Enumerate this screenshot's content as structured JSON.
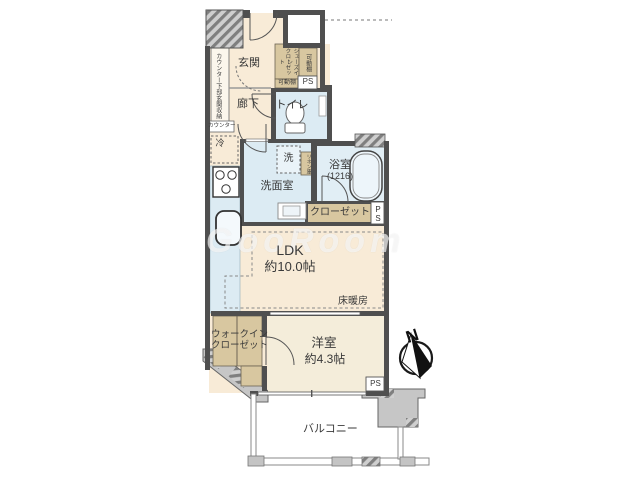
{
  "t": {
    "entrance": "玄関",
    "hallway": "廊下",
    "toilet": "トイレ",
    "washroom": "洗面室",
    "bath": "浴室",
    "bath_size": "(1216)",
    "closet": "クローゼット",
    "ldk": "LDK",
    "ldk_size": "約10.0帖",
    "floor_heating": "床暖房",
    "western": "洋室",
    "western_size": "約4.3帖",
    "balcony": "バルコニー",
    "wic1": "ウォークイン",
    "wic2": "クローゼット",
    "sic1": "シューズイン",
    "sic2": "クローゼット",
    "shelf_v": "可動棚",
    "shelf_h": "可動棚",
    "counter_storage": "カウンター下部玄関収納",
    "counter": "カウンター",
    "linen": "リネン庫",
    "fridge": "冷",
    "washer": "洗",
    "ps_top": "PS",
    "ps_right1": "P",
    "ps_right2": "S",
    "ps_bottom": "PS",
    "north": "N",
    "watermark": "GooRoom"
  },
  "colors": {
    "floor_main": "#f8ebd7",
    "floor_west_room": "#f4edda",
    "floor_wet": "#dcebf3",
    "storage_tan": "#d8c7a0",
    "wall": "#4f4f4f",
    "hatch_gray": "#8a8a8a",
    "watermark_white": "#ffffff"
  }
}
